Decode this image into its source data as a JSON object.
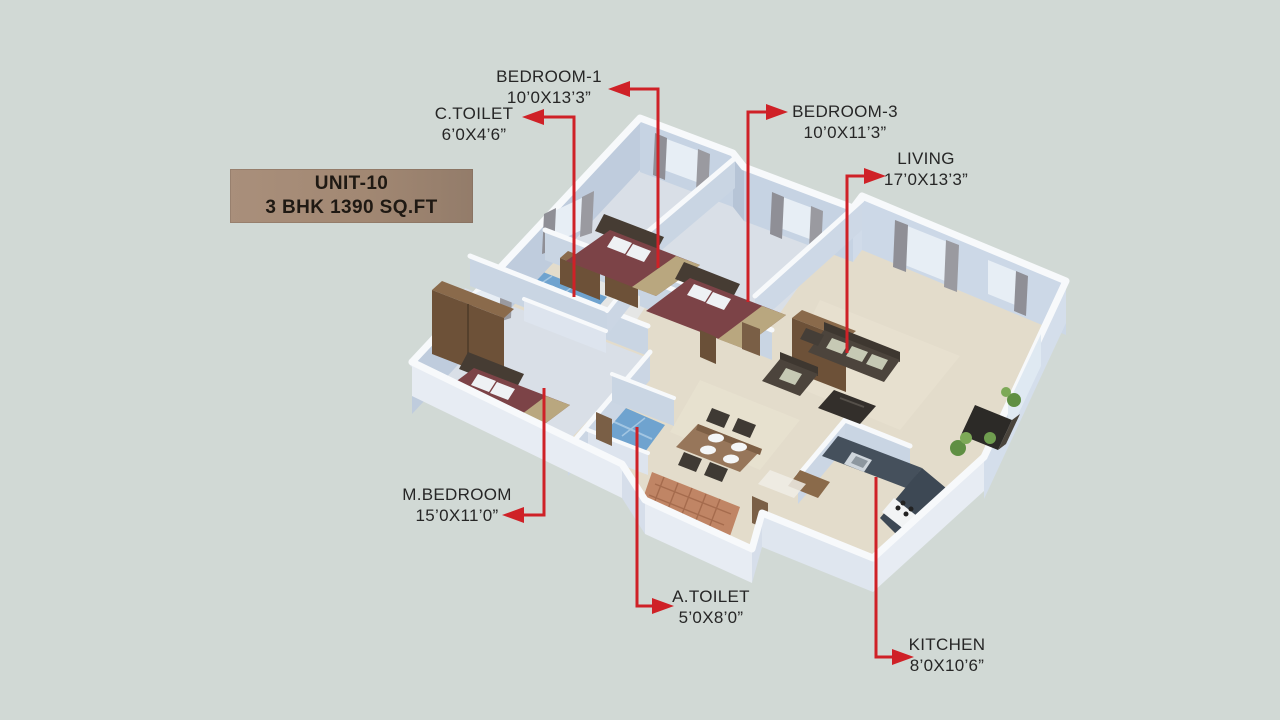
{
  "scene": {
    "title": "3D isometric floor plan render",
    "background_color": "#d1d9d5",
    "leader_line_color": "#cf2127",
    "wall_color": "#c8d4e3",
    "wall_top_color": "#f7f9fb",
    "floor_color": "#e2dbca",
    "tile_color": "#6fa3cf",
    "terracotta_color": "#c08565",
    "bed_color": "#7c4347",
    "wood_color": "#6d5138"
  },
  "unit_box": {
    "line1": "UNIT-10",
    "line2": "3 BHK 1390 SQ.FT"
  },
  "labels": [
    {
      "id": "bedroom1",
      "name": "BEDROOM-1",
      "size": "10’0X13’3”"
    },
    {
      "id": "ctoilet",
      "name": "C.TOILET",
      "size": "6’0X4’6”"
    },
    {
      "id": "bedroom3",
      "name": "BEDROOM-3",
      "size": "10’0X11’3”"
    },
    {
      "id": "living",
      "name": "LIVING",
      "size": "17’0X13’3”"
    },
    {
      "id": "mbedroom",
      "name": "M.BEDROOM",
      "size": "15’0X11’0”"
    },
    {
      "id": "atoilet",
      "name": "A.TOILET",
      "size": "5’0X8’0”"
    },
    {
      "id": "kitchen",
      "name": "KITCHEN",
      "size": "8’0X10’6”"
    }
  ]
}
